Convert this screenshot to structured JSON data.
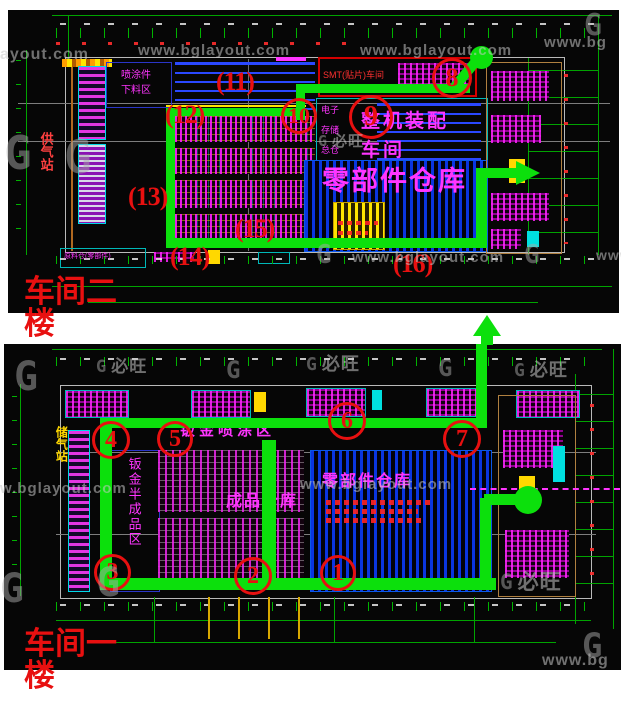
{
  "watermark": {
    "site": "www.bglayout.com",
    "site_partial_left": "ayout.com",
    "site_partial_left2": "w.bglayout.com",
    "site_short": "www.bg",
    "site_tiny": "www",
    "brand": "必旺",
    "logo_glyph": "G"
  },
  "colors": {
    "route_green": "#0ce00c",
    "station_red": "#e81010",
    "cad_green": "#00a400",
    "cad_magenta": "#ff35ff",
    "cad_blue": "#0a35e0",
    "cad_yellow": "#ffe400",
    "cad_cyan": "#00b8b8"
  },
  "plans": [
    {
      "floor_label": "车间二楼",
      "rooms": {
        "paint_unload": "喷涂件下料区",
        "gas_station": "供气站",
        "smt_line": "SMT(贴片)车间",
        "assembly": "整机装配车间",
        "elec": [
          "电子",
          "存储",
          "总仓"
        ],
        "parts_warehouse": "零部件仓库",
        "raw_material": "原料仓(零部件)"
      },
      "stations": [
        {
          "label": "8"
        },
        {
          "label": "9"
        },
        {
          "label": "10"
        },
        {
          "label": "(11)"
        },
        {
          "label": "(12)"
        },
        {
          "label": "(13)"
        },
        {
          "label": "(14)"
        },
        {
          "label": "(15)"
        },
        {
          "label": "(16)"
        }
      ]
    },
    {
      "floor_label": "车间一楼",
      "rooms": {
        "gas_station": "储气站",
        "semi_finished": "钣金半成品区",
        "paint_area": "钣金喷涂区",
        "finished_goods": "成品仓库",
        "parts_warehouse": "零部件仓库"
      },
      "stations": [
        {
          "label": "1"
        },
        {
          "label": "2"
        },
        {
          "label": "3"
        },
        {
          "label": "4"
        },
        {
          "label": "5"
        },
        {
          "label": "6"
        },
        {
          "label": "7"
        }
      ]
    }
  ]
}
